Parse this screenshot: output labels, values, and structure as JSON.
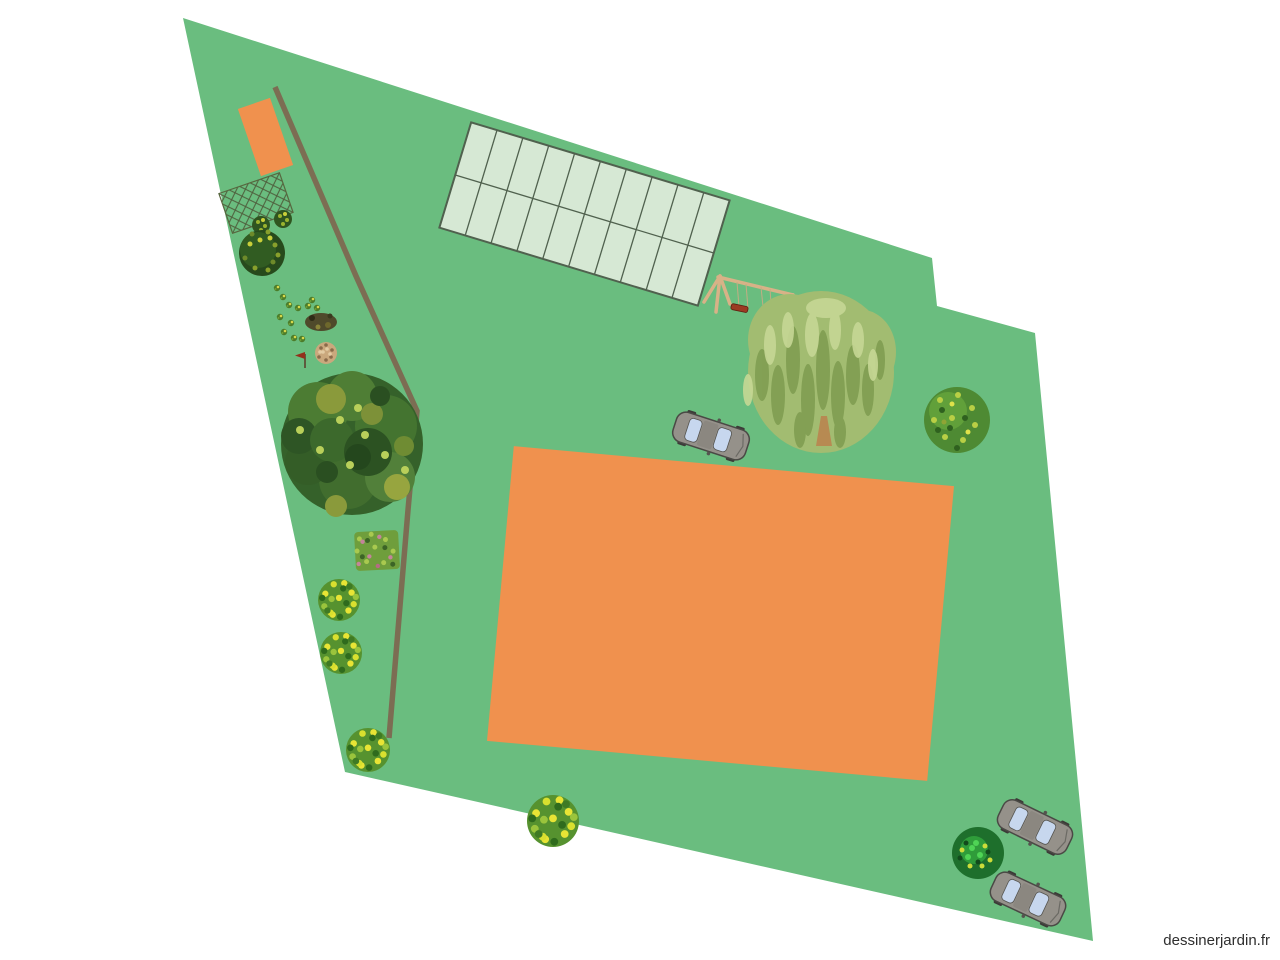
{
  "app": {
    "watermark": "dessinerjardin.fr"
  },
  "canvas": {
    "width_px": 1280,
    "height_px": 960,
    "background": "#ffffff"
  },
  "colors": {
    "lawn": "#6abd7f",
    "structure-orange": "#f0914e",
    "path-brown": "#7c6d53",
    "greenhouse-fill": "#d6e8d4",
    "greenhouse-stroke": "#50614e",
    "wood-tan": "#d8b287",
    "swing-seat-red": "#9b3a22",
    "car-body": "#95918a",
    "car-window": "#c7d7ee",
    "watermark-gray": "#2e2e2e"
  },
  "scene": {
    "plot": {
      "type": "lawn-polygon",
      "sides": 6
    },
    "objects": [
      {
        "name": "small-orange-structure",
        "type": "rectangle"
      },
      {
        "name": "garden-path",
        "type": "path-line"
      },
      {
        "name": "trellis",
        "type": "lattice-panel"
      },
      {
        "name": "large-dark-bush",
        "type": "shrub"
      },
      {
        "name": "small-shrub",
        "count": 2
      },
      {
        "name": "wildflower-sprig",
        "count": 12
      },
      {
        "name": "dried-flower-bush",
        "type": "shrub"
      },
      {
        "name": "marker-flag",
        "type": "flag"
      },
      {
        "name": "large-oak-tree",
        "type": "tree"
      },
      {
        "name": "flower-bed",
        "type": "planting-patch"
      },
      {
        "name": "yellow-flowering-bush",
        "count": 4
      },
      {
        "name": "vegetable-grid",
        "type": "grid",
        "rows": 2,
        "columns": 10
      },
      {
        "name": "swing-set",
        "type": "play-structure"
      },
      {
        "name": "weeping-willow",
        "type": "tree"
      },
      {
        "name": "round-shrub-right",
        "type": "shrub"
      },
      {
        "name": "house-footprint",
        "type": "rectangle"
      },
      {
        "name": "car",
        "count": 3
      },
      {
        "name": "dark-shrub-bottom-right",
        "type": "shrub"
      }
    ]
  }
}
